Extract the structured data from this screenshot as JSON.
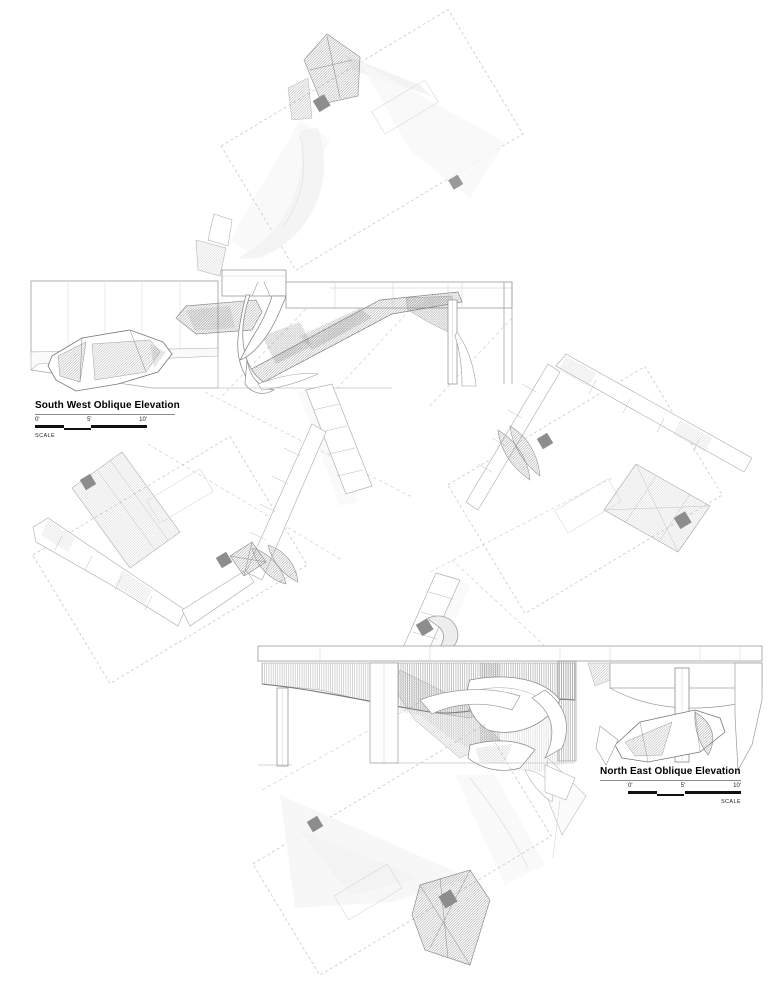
{
  "titles": {
    "sw": {
      "title": "South West Oblique Elevation",
      "t0": "0'",
      "t5": "5'",
      "t10": "10'",
      "scale_label": "SCALE"
    },
    "ne": {
      "title": "North East Oblique Elevation",
      "t0": "0'",
      "t5": "5'",
      "t10": "10'",
      "scale_label": "SCALE"
    }
  },
  "palette": {
    "line_gray": "#9a9a9a",
    "hatch_gray": "#8a8a8a",
    "dash_gray": "#cccccc",
    "marker_gray": "#8d8d8d",
    "bar_black": "#111111",
    "text_black": "#000000"
  }
}
